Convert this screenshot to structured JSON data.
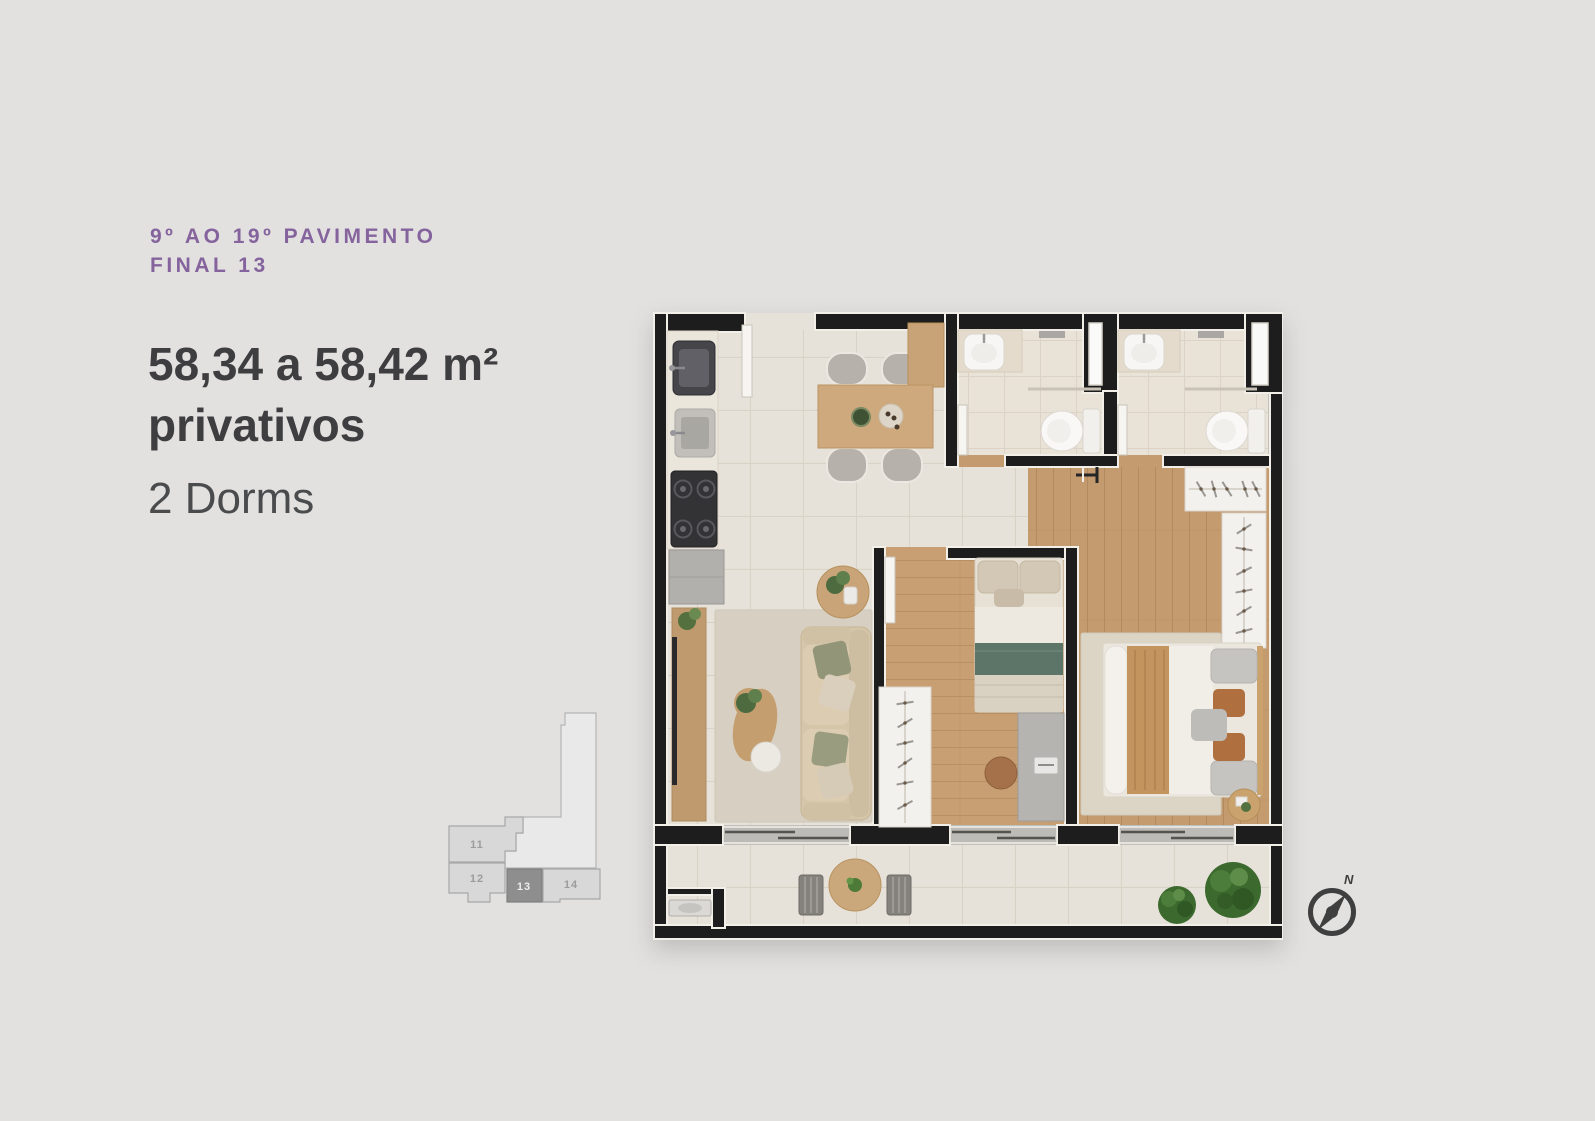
{
  "header": {
    "floor_range": "9º AO 19º PAVIMENTO",
    "unit_final": "FINAL 13",
    "accent_color": "#85639d"
  },
  "details": {
    "area": "58,34 a 58,42 m²",
    "area_suffix": "privativos",
    "dorms": "2 Dorms",
    "text_color": "#3e3e40"
  },
  "key_plan": {
    "units": [
      {
        "label": "11",
        "highlighted": false
      },
      {
        "label": "12",
        "highlighted": false
      },
      {
        "label": "13",
        "highlighted": true
      },
      {
        "label": "14",
        "highlighted": false
      }
    ],
    "highlight_color": "#8e8e8e"
  },
  "compass": {
    "north_label": "N"
  },
  "page": {
    "background": "#e2e1e0",
    "wall_color": "#1d1d1d"
  }
}
